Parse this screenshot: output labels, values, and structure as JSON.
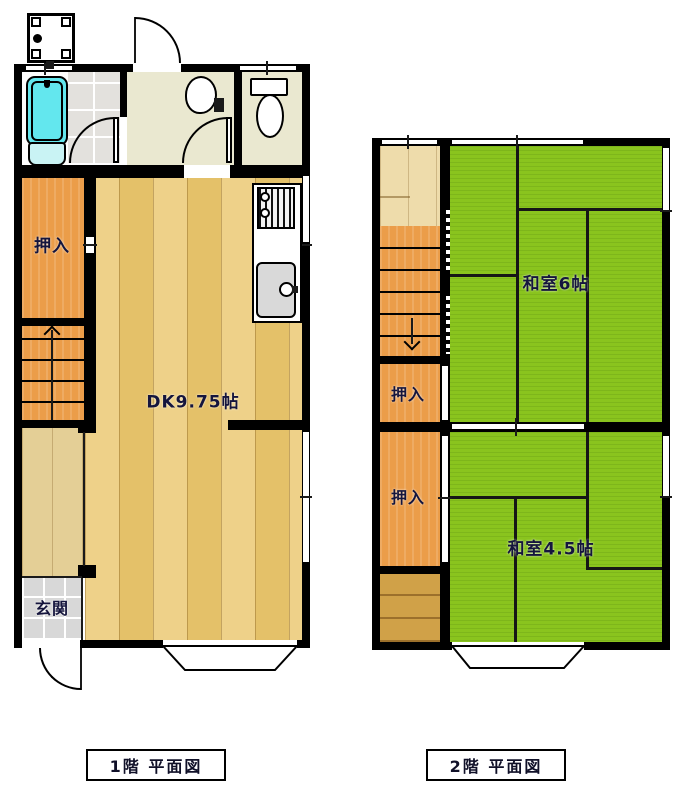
{
  "floor1": {
    "caption": "1階 平面図",
    "rooms": {
      "closet": "押入",
      "dk": "DK9.75帖",
      "genkan": "玄関"
    }
  },
  "floor2": {
    "caption": "2階 平面図",
    "rooms": {
      "washitsu6": "和室6帖",
      "closet_upper": "押入",
      "closet_lower": "押入",
      "washitsu45": "和室4.5帖"
    }
  },
  "colors": {
    "wall": "#000000",
    "tatami": "#8ac41e",
    "closet": "#eb9d49",
    "hall_wood": "#e4cf96",
    "landing_wood": "#eedcab",
    "dark_wood": "#d0a148",
    "tile": "#d8d8d8",
    "bath_tile": "#e3e1dd",
    "wet_floor": "#eae8d0",
    "tub": "#63e7ee"
  }
}
